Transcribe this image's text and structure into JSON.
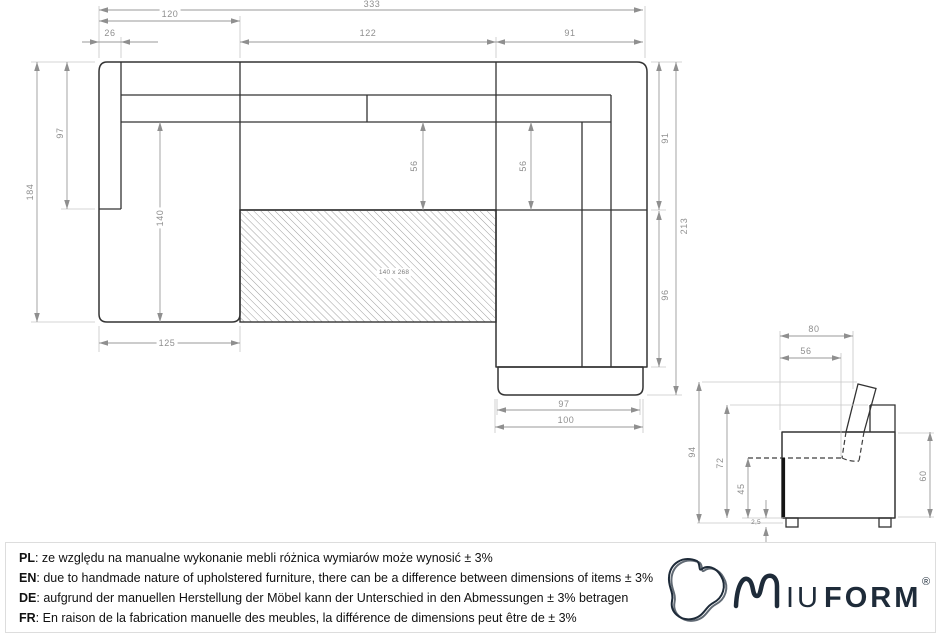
{
  "top_view": {
    "sleeping_area": "140 x 268",
    "dims": {
      "overall_width": "333",
      "left_section_width": "120",
      "armrest_width": "26",
      "middle_width": "122",
      "right_width": "91",
      "left_depth": "184",
      "armrest_length": "97",
      "chaise_length": "140",
      "seat_depth_middle": "56",
      "seat_depth_right": "56",
      "right_depth_top": "91",
      "right_depth_total": "213",
      "right_chaise_length": "96",
      "chaise_width": "125",
      "footer_width_top": "97",
      "footer_width": "100"
    }
  },
  "side_view": {
    "dims": {
      "armrest_top_width": "80",
      "seat_depth": "56",
      "total_height": "94",
      "backrest_height": "72",
      "seat_height": "45",
      "clearance": "2,5",
      "body_height": "60"
    }
  },
  "footer": {
    "notes": [
      {
        "label": "PL",
        "text": ": ze względu na manualne wykonanie mebli różnica wymiarów może wynosić ± 3%"
      },
      {
        "label": "EN",
        "text": ": due to handmade nature of upholstered furniture, there can be a difference between dimensions of items ± 3%"
      },
      {
        "label": "DE",
        "text": ": aufgrund der manuellen Herstellung der Möbel kann der Unterschied in den Abmessungen ± 3% betragen"
      },
      {
        "label": "FR",
        "text": ": En raison de la fabrication manuelle des meubles, la différence de dimensions peut être de ± 3%"
      }
    ]
  },
  "logo": {
    "iu": "IU",
    "form": "FORM",
    "reg": "®"
  }
}
